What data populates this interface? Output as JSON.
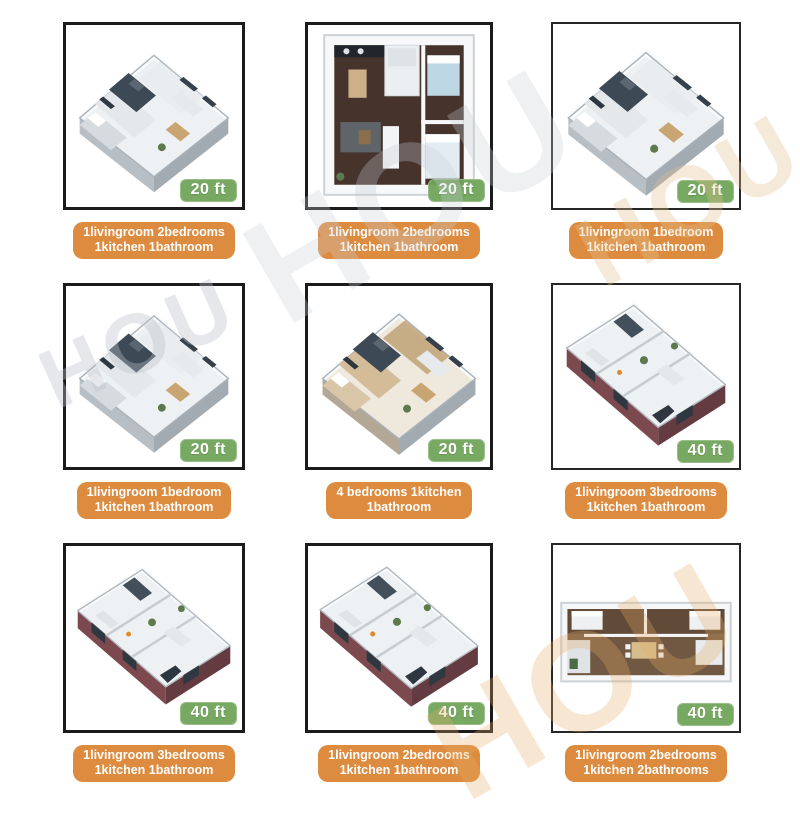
{
  "page": {
    "background": "#ffffff"
  },
  "colors": {
    "badge_green": "#71a45a",
    "caption_orange": "#dd8b3e",
    "frame_border": "#1b1b1b",
    "watermark_gray": "#bac1c7",
    "watermark_tan": "#e4ac66"
  },
  "watermarks": [
    {
      "text": "HOU"
    },
    {
      "text": "HOU"
    },
    {
      "text": "HOU"
    },
    {
      "text": "HOU"
    }
  ],
  "tiles": [
    {
      "size_label": "20 ft",
      "caption_line1": "1livingroom 2bedrooms",
      "caption_line2": "1kitchen 1bathroom",
      "plan": "isometric-square",
      "palette": "cool"
    },
    {
      "size_label": "20 ft",
      "caption_line1": "1livingroom 2bedrooms",
      "caption_line2": "1kitchen 1bathroom",
      "plan": "topdown-square",
      "palette": "walnut"
    },
    {
      "size_label": "20 ft",
      "caption_line1": "1livingroom 1bedroom",
      "caption_line2": "1kitchen 1bathroom",
      "plan": "isometric-square",
      "palette": "cool"
    },
    {
      "size_label": "20 ft",
      "caption_line1": "1livingroom 1bedroom",
      "caption_line2": "1kitchen 1bathroom",
      "plan": "isometric-square",
      "palette": "cool"
    },
    {
      "size_label": "20 ft",
      "caption_line1": "4 bedrooms 1kitchen",
      "caption_line2": "1bathroom",
      "plan": "isometric-square",
      "palette": "warm"
    },
    {
      "size_label": "40 ft",
      "caption_line1": "1livingroom 3bedrooms",
      "caption_line2": "1kitchen 1bathroom",
      "plan": "isometric-long",
      "palette": "maroon"
    },
    {
      "size_label": "40 ft",
      "caption_line1": "1livingroom 3bedrooms",
      "caption_line2": "1kitchen 1bathroom",
      "plan": "isometric-long",
      "palette": "maroon"
    },
    {
      "size_label": "40 ft",
      "caption_line1": "1livingroom 2bedrooms",
      "caption_line2": "1kitchen 1bathroom",
      "plan": "isometric-long",
      "palette": "maroon"
    },
    {
      "size_label": "40 ft",
      "caption_line1": "1livingroom 2bedrooms",
      "caption_line2": "1kitchen 2bathrooms",
      "plan": "topdown-wide",
      "palette": "brown"
    }
  ]
}
